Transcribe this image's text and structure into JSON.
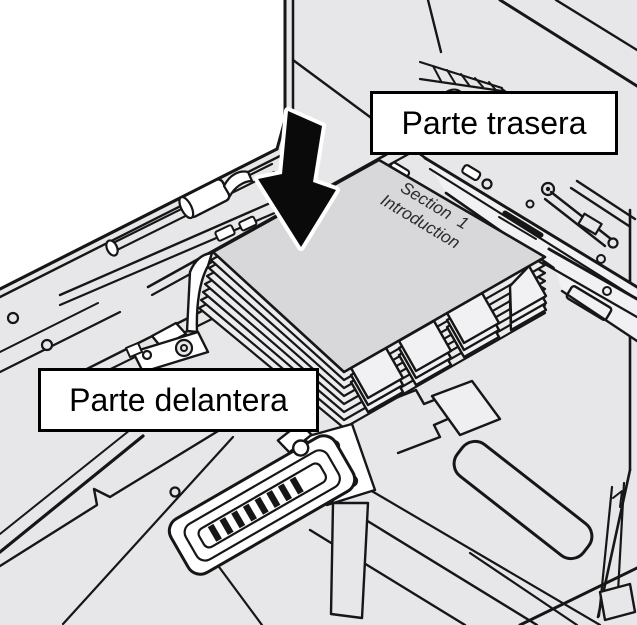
{
  "illustration": {
    "kind": "printer-paper-tray-loading-diagram",
    "labels": {
      "back": "Parte trasera",
      "front": "Parte delantera"
    },
    "paper_stack_text": {
      "line1": "Section 1",
      "line2": "Introduction"
    },
    "icons": {
      "arrow": "down-arrow-icon"
    },
    "colors": {
      "background": "#e7e7e9",
      "line": "#161616",
      "cover_white": "#ffffff",
      "paper_top": "#d8d8da",
      "paper_edge": "#ececee",
      "tab": "#f1f1f3",
      "arrow_fill": "#0a0a0a",
      "arrow_outline": "#ffffff",
      "label_background": "#ffffff",
      "label_border": "#000000"
    }
  }
}
